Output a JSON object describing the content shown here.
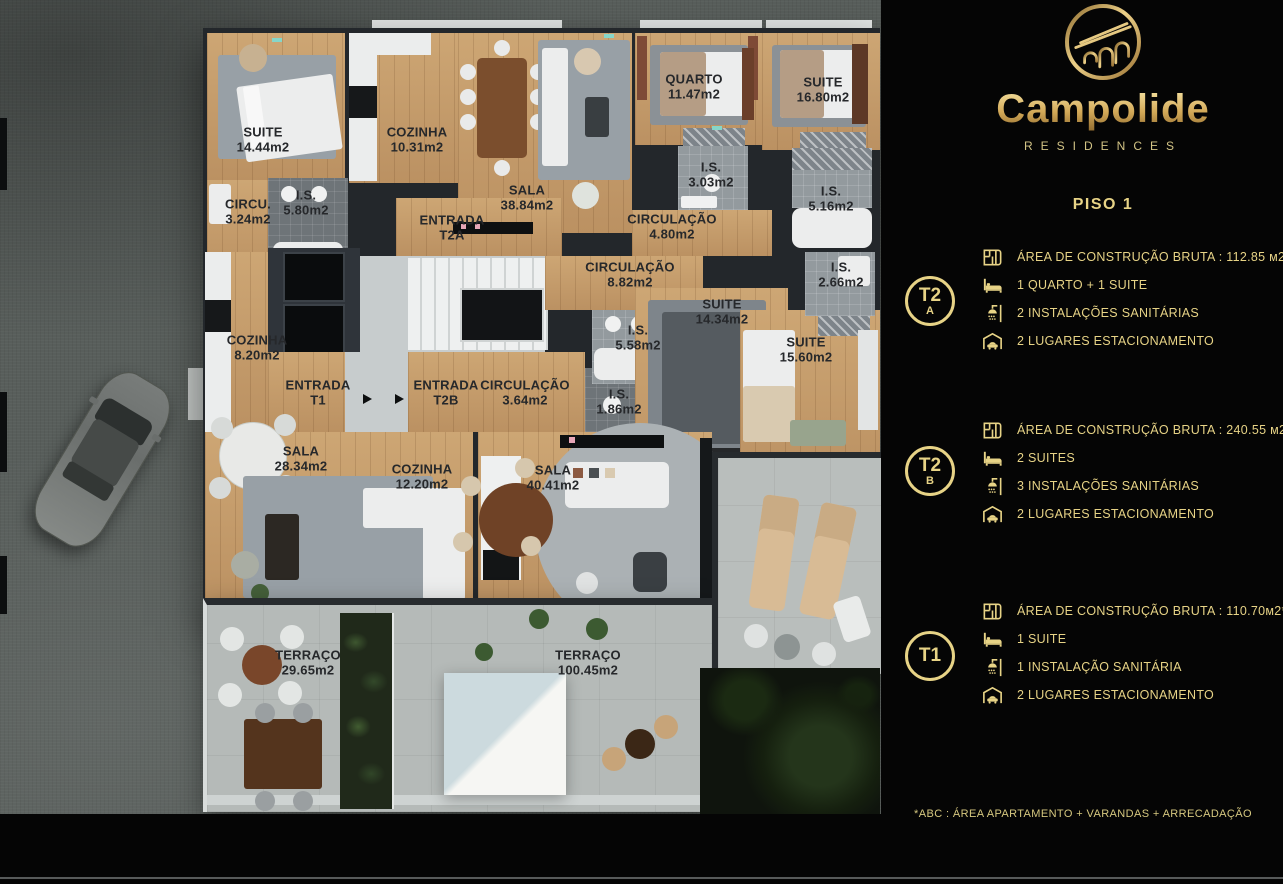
{
  "brand": {
    "name": "Campolide",
    "tagline": "RESIDENCES"
  },
  "panel": {
    "floor_title": "PISO 1",
    "units": [
      {
        "id": "T2A",
        "badge_line1": "T2",
        "badge_line2": "A",
        "features": [
          {
            "icon": "area-plan-icon",
            "text": "ÁREA DE CONSTRUÇÃO BRUTA :  112.85 м2*"
          },
          {
            "icon": "bed-icon",
            "text": "1 QUARTO + 1 SUITE"
          },
          {
            "icon": "shower-icon",
            "text": "2 INSTALAÇÕES SANITÁRIAS"
          },
          {
            "icon": "garage-icon",
            "text": "2 LUGARES ESTACIONAMENTO"
          }
        ]
      },
      {
        "id": "T2B",
        "badge_line1": "T2",
        "badge_line2": "B",
        "features": [
          {
            "icon": "area-plan-icon",
            "text": "ÁREA DE CONSTRUÇÃO BRUTA :  240.55 м2*"
          },
          {
            "icon": "bed-icon",
            "text": "2 SUITES"
          },
          {
            "icon": "shower-icon",
            "text": "3 INSTALAÇÕES SANITÁRIAS"
          },
          {
            "icon": "garage-icon",
            "text": "2 LUGARES ESTACIONAMENTO"
          }
        ]
      },
      {
        "id": "T1",
        "badge_line1": "T1",
        "badge_line2": "",
        "features": [
          {
            "icon": "area-plan-icon",
            "text": "ÁREA DE CONSTRUÇÃO BRUTA :  110.70м2*"
          },
          {
            "icon": "bed-icon",
            "text": "1 SUITE"
          },
          {
            "icon": "shower-icon",
            "text": "1 INSTALAÇÃO SANITÁRIA"
          },
          {
            "icon": "garage-icon",
            "text": "2 LUGARES ESTACIONAMENTO"
          }
        ]
      }
    ],
    "footnote": "*ABC :  ÁREA APARTAMENTO + VARANDAS + ARRECADAÇÃO"
  },
  "floor_plan": {
    "rooms": [
      {
        "name": "SUITE",
        "area": "14.44m2",
        "cx": 263,
        "cy": 140
      },
      {
        "name": "COZINHA",
        "area": "10.31m2",
        "cx": 417,
        "cy": 140
      },
      {
        "name": "SALA",
        "area": "38.84m2",
        "cx": 527,
        "cy": 198
      },
      {
        "name": "QUARTO",
        "area": "11.47m2",
        "cx": 694,
        "cy": 87
      },
      {
        "name": "SUITE",
        "area": "16.80m2",
        "cx": 823,
        "cy": 90
      },
      {
        "name": "CIRCU.",
        "area": "3.24m2",
        "cx": 248,
        "cy": 212
      },
      {
        "name": "I.S.",
        "area": "5.80m2",
        "cx": 306,
        "cy": 203
      },
      {
        "name": "ENTRADA",
        "area": "T2A",
        "cx": 452,
        "cy": 228
      },
      {
        "name": "I.S.",
        "area": "3.03m2",
        "cx": 711,
        "cy": 175
      },
      {
        "name": "CIRCULAÇÃO",
        "area": "4.80m2",
        "cx": 672,
        "cy": 227
      },
      {
        "name": "I.S.",
        "area": "5.16m2",
        "cx": 831,
        "cy": 199
      },
      {
        "name": "CIRCULAÇÃO",
        "area": "8.82m2",
        "cx": 630,
        "cy": 275
      },
      {
        "name": "I.S.",
        "area": "2.66m2",
        "cx": 841,
        "cy": 275
      },
      {
        "name": "SUITE",
        "area": "14.34m2",
        "cx": 722,
        "cy": 312
      },
      {
        "name": "I.S.",
        "area": "5.58m2",
        "cx": 638,
        "cy": 338
      },
      {
        "name": "SUITE",
        "area": "15.60m2",
        "cx": 806,
        "cy": 350
      },
      {
        "name": "COZINHA",
        "area": "8.20m2",
        "cx": 257,
        "cy": 348
      },
      {
        "name": "ENTRADA",
        "area": "T1",
        "cx": 318,
        "cy": 393
      },
      {
        "name": "ENTRADA",
        "area": "T2B",
        "cx": 446,
        "cy": 393
      },
      {
        "name": "CIRCULAÇÃO",
        "area": "3.64m2",
        "cx": 525,
        "cy": 393
      },
      {
        "name": "I.S.",
        "area": "1.86m2",
        "cx": 619,
        "cy": 402
      },
      {
        "name": "SALA",
        "area": "28.34m2",
        "cx": 301,
        "cy": 459
      },
      {
        "name": "COZINHA",
        "area": "12.20m2",
        "cx": 422,
        "cy": 477
      },
      {
        "name": "SALA",
        "area": "40.41m2",
        "cx": 553,
        "cy": 478
      },
      {
        "name": "TERRAÇO",
        "area": "29.65m2",
        "cx": 308,
        "cy": 663
      },
      {
        "name": "TERRAÇO",
        "area": "100.45m2",
        "cx": 588,
        "cy": 663
      }
    ]
  },
  "colors": {
    "accent_gold": "#e7d386",
    "wood": "#c7a06c",
    "wall": "#23272b",
    "terrace": "#b5bab8",
    "panel_bg": "#050505"
  }
}
